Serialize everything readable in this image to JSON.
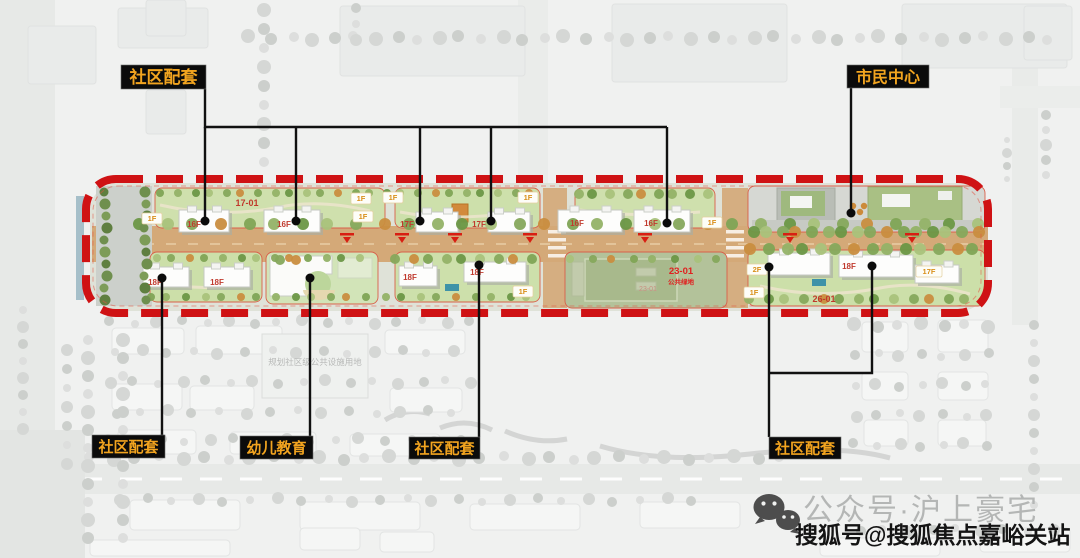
{
  "callouts": [
    {
      "label": "社区配套",
      "box": [
        121,
        65,
        85,
        24
      ],
      "font": 17,
      "paths": [
        "M205,89 V127 H667",
        "M205,127 V220",
        "M296,127 V220",
        "M420,127 V220",
        "M491,127 V220",
        "M667,127 V222"
      ],
      "dots": [
        [
          205,
          221
        ],
        [
          296,
          221
        ],
        [
          420,
          221
        ],
        [
          491,
          221
        ],
        [
          667,
          223
        ]
      ]
    },
    {
      "label": "市民中心",
      "box": [
        847,
        65,
        82,
        23
      ],
      "font": 16,
      "paths": [
        "M851,88 V211"
      ],
      "dots": [
        [
          851,
          213
        ]
      ]
    },
    {
      "label": "社区配套",
      "box": [
        92,
        435,
        73,
        23
      ],
      "font": 15,
      "paths": [
        "M162,435 V280"
      ],
      "dots": [
        [
          162,
          278
        ]
      ]
    },
    {
      "label": "幼儿教育",
      "box": [
        240,
        436,
        73,
        23
      ],
      "font": 15,
      "paths": [
        "M310,436 V280"
      ],
      "dots": [
        [
          310,
          278
        ]
      ]
    },
    {
      "label": "社区配套",
      "box": [
        409,
        437,
        71,
        22
      ],
      "font": 15,
      "paths": [
        "M479,437 V267"
      ],
      "dots": [
        [
          479,
          265
        ]
      ]
    },
    {
      "label": "社区配套",
      "box": [
        769,
        437,
        72,
        22
      ],
      "font": 15,
      "paths": [
        "M769,437 V269",
        "M769,373 H872 V268"
      ],
      "dots": [
        [
          769,
          267
        ],
        [
          872,
          266
        ]
      ]
    }
  ],
  "plan_labels": [
    {
      "t": "17-01",
      "x": 247,
      "y": 206,
      "s": "code"
    },
    {
      "t": "16F",
      "x": 194,
      "y": 227,
      "s": "floor"
    },
    {
      "t": "16F",
      "x": 284,
      "y": 227,
      "s": "floor"
    },
    {
      "t": "1F",
      "x": 152,
      "y": 221,
      "s": "chip"
    },
    {
      "t": "1F",
      "x": 361,
      "y": 201,
      "s": "chip"
    },
    {
      "t": "1F",
      "x": 363,
      "y": 219,
      "s": "chip"
    },
    {
      "t": "17F",
      "x": 407,
      "y": 227,
      "s": "floor"
    },
    {
      "t": "17F",
      "x": 479,
      "y": 227,
      "s": "floor"
    },
    {
      "t": "1F",
      "x": 393,
      "y": 200,
      "s": "chip"
    },
    {
      "t": "1F",
      "x": 528,
      "y": 200,
      "s": "chip"
    },
    {
      "t": "16F",
      "x": 577,
      "y": 226,
      "s": "floor"
    },
    {
      "t": "16F",
      "x": 651,
      "y": 226,
      "s": "floor"
    },
    {
      "t": "1F",
      "x": 712,
      "y": 225,
      "s": "chip"
    },
    {
      "t": "18F",
      "x": 155,
      "y": 285,
      "s": "floor"
    },
    {
      "t": "18F",
      "x": 217,
      "y": 285,
      "s": "floor"
    },
    {
      "t": "18F",
      "x": 410,
      "y": 280,
      "s": "floor"
    },
    {
      "t": "18F",
      "x": 477,
      "y": 275,
      "s": "floor"
    },
    {
      "t": "1F",
      "x": 523,
      "y": 294,
      "s": "chip"
    },
    {
      "t": "23-01",
      "x": 648,
      "y": 291,
      "s": "code-faint"
    },
    {
      "t": "23-01",
      "x": 681,
      "y": 274,
      "s": "code-bright"
    },
    {
      "t": "公共绿地",
      "x": 681,
      "y": 284,
      "s": "code-bright-sm"
    },
    {
      "t": "2F",
      "x": 757,
      "y": 272,
      "s": "chip"
    },
    {
      "t": "18F",
      "x": 849,
      "y": 269,
      "s": "floor"
    },
    {
      "t": "17F",
      "x": 929,
      "y": 274,
      "s": "chip"
    },
    {
      "t": "1F",
      "x": 754,
      "y": 295,
      "s": "chip"
    },
    {
      "t": "26-01",
      "x": 824,
      "y": 302,
      "s": "code"
    }
  ],
  "background_note": "规划社区级公共设施用地",
  "watermark": {
    "wechat": "公众号·沪上豪宅",
    "sohu": "搜狐号@搜狐焦点嘉峪关站"
  },
  "colors": {
    "boundary_red": "#cf1214",
    "thin_red": "#d9604a",
    "road_tan": "#d4a978",
    "parcel_green": "#cfe0ad",
    "field_green": "#b3c29a",
    "callout_bg": "#0b0b0b",
    "callout_text": "#f2a41f",
    "leader_black": "#111111",
    "floor_label_red": "#c03a2e",
    "chip_orange": "#d98f1a",
    "watermark_gray": "#b4b6b5",
    "watermark_black": "#141414"
  }
}
